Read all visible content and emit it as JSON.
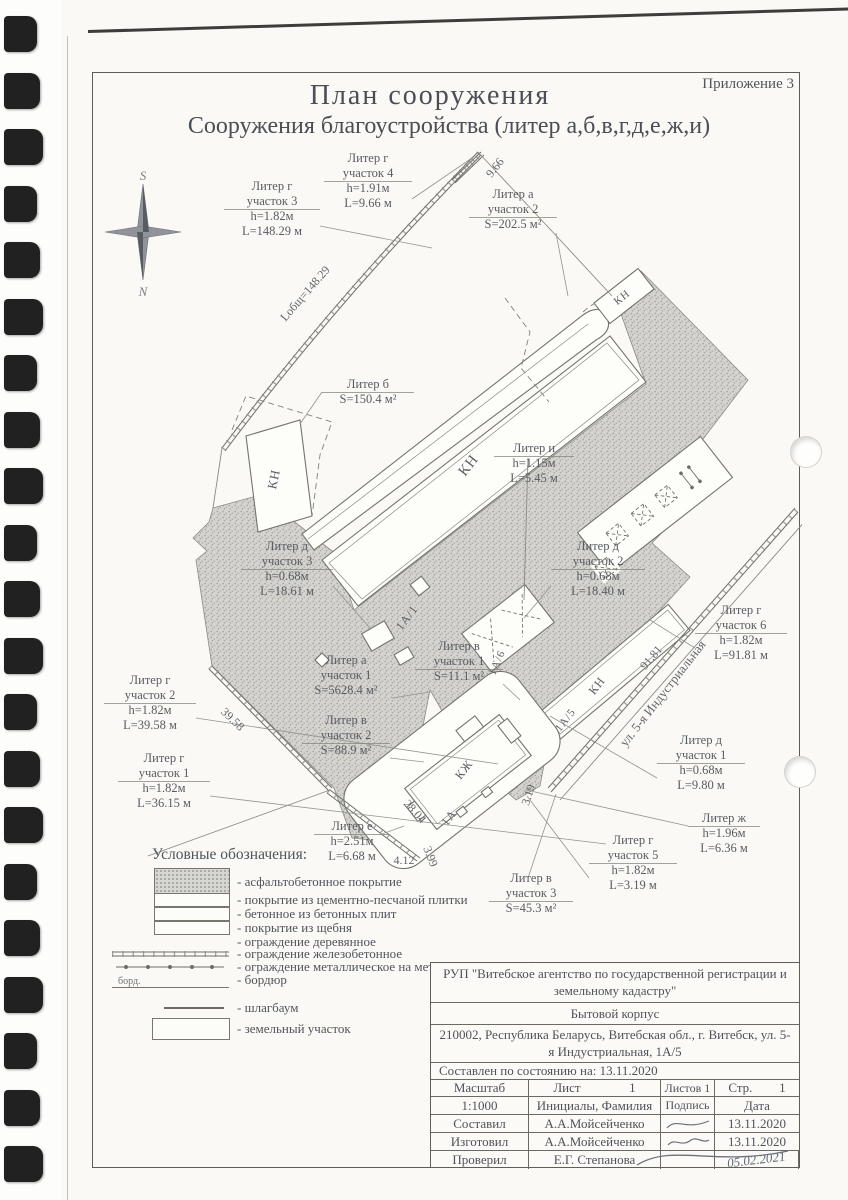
{
  "page": {
    "appendix": "Приложение 3",
    "title": "План сооружения",
    "subtitle": "Сооружения  благоустройства (литер а,б,в,г,д,е,ж,и)"
  },
  "compass": {
    "top": "S",
    "bottom": "N"
  },
  "plan": {
    "labels": {
      "g4": {
        "lines": [
          "Литер г",
          "участок 4",
          "h=1.91м",
          "L=9.66 м"
        ]
      },
      "g3": {
        "lines": [
          "Литер г",
          "участок 3",
          "h=1.82м",
          "L=148.29 м"
        ]
      },
      "a2": {
        "lines": [
          "Литер а",
          "участок 2",
          "S=202.5 м²"
        ]
      },
      "b": {
        "lines": [
          "Литер б",
          "S=150.4 м²"
        ]
      },
      "i": {
        "lines": [
          "Литер и",
          "h=1.15м",
          "L=5.45 м"
        ]
      },
      "d3": {
        "lines": [
          "Литер д",
          "участок 3",
          "h=0.68м",
          "L=18.61 м"
        ]
      },
      "d2": {
        "lines": [
          "Литер д",
          "участок 2",
          "h=0.68м",
          "L=18.40 м"
        ]
      },
      "v1": {
        "lines": [
          "Литер в",
          "участок 1",
          "S=11.1 м²"
        ]
      },
      "a1": {
        "lines": [
          "Литер а",
          "участок 1",
          "S=5628.4 м²"
        ]
      },
      "g6": {
        "lines": [
          "Литер г",
          "участок 6",
          "h=1.82м",
          "L=91.81 м"
        ]
      },
      "g2": {
        "lines": [
          "Литер г",
          "участок 2",
          "h=1.82м",
          "L=39.58 м"
        ]
      },
      "v2": {
        "lines": [
          "Литер в",
          "участок 2",
          "S=88.9 м²"
        ]
      },
      "g1": {
        "lines": [
          "Литер г",
          "участок 1",
          "h=1.82м",
          "L=36.15 м"
        ]
      },
      "d1": {
        "lines": [
          "Литер д",
          "участок 1",
          "h=0.68м",
          "L=9.80 м"
        ]
      },
      "e": {
        "lines": [
          "Литер е",
          "h=2.51м",
          "L=6.68 м"
        ]
      },
      "zh": {
        "lines": [
          "Литер ж",
          "h=1.96м",
          "L=6.36 м"
        ]
      },
      "g5": {
        "lines": [
          "Литер г",
          "участок 5",
          "h=1.82м",
          "L=3.19 м"
        ]
      },
      "v3": {
        "lines": [
          "Литер в",
          "участок 3",
          "S=45.3 м²"
        ]
      }
    },
    "dims": {
      "d966": "9.66",
      "d14829": "Lобщ=148.29",
      "d3958": "39.58",
      "d9181": "91.81",
      "d2804": "28.04",
      "d412": "4.12",
      "d399": "3.99",
      "d319": "3.19"
    },
    "buildings": {
      "kn": "КН",
      "kzh": "КЖ",
      "b1a": "1А",
      "b1a1": "1А/1",
      "b1a5": "1А/5",
      "b1a6": "1А/6"
    },
    "street": "ул. 5-я Индустриальная"
  },
  "legend": {
    "title": "Условные обозначения:",
    "curb_tag": "борд.",
    "items": [
      "- асфальтобетонное покрытие",
      "- покрытие из цементно-песчаной плитки",
      "- бетонное из бетонных плит",
      "- покрытие из щебня",
      "- ограждение деревянное",
      "- ограждение железобетонное",
      "- ограждение металлическое на металлических столбах",
      "- бордюр",
      "- шлагбаум",
      "- земельный участок"
    ]
  },
  "titleblock": {
    "org": "РУП \"Витебское агентство по государственной регистрации и земельному кадастру\"",
    "object": "Бытовой корпус",
    "address": "210002, Республика Беларусь, Витебская обл., г. Витебск, ул. 5-я Индустриальная, 1А/5",
    "compiled": "Составлен по состоянию на: 13.11.2020",
    "scale_label": "Масштаб",
    "scale_value": "1:1000",
    "sheet_label": "Лист",
    "sheet_value": "1",
    "sheets_label": "Листов 1",
    "page_label": "Стр.",
    "page_value": "1",
    "name_header": "Инициалы, Фамилия",
    "sign_header": "Подпись",
    "date_header": "Дата",
    "rows": [
      {
        "role": "Составил",
        "name": "А.А.Мойсейченко",
        "date": "13.11.2020"
      },
      {
        "role": "Изготовил",
        "name": "А.А.Мойсейченко",
        "date": "13.11.2020"
      },
      {
        "role": "Проверил",
        "name": "Е.Г. Степанова",
        "date": "05.02.2021"
      }
    ]
  }
}
